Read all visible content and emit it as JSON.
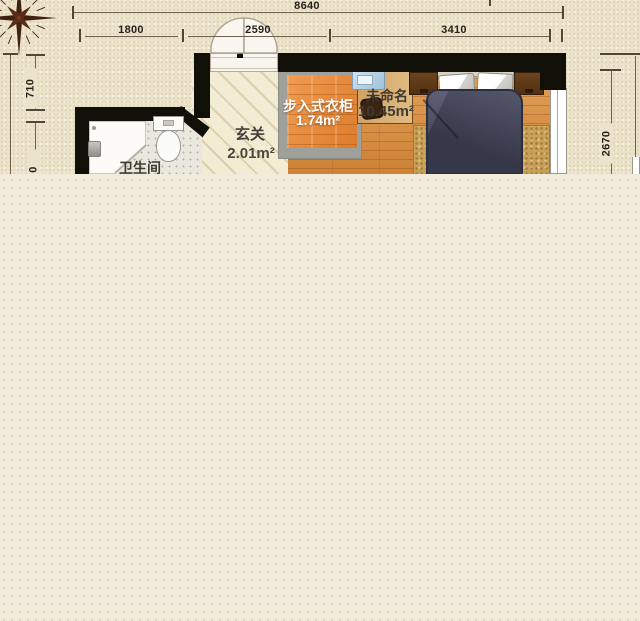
{
  "plan": {
    "title": "apartment-floor-plan",
    "dimensions": {
      "total_width": "8640",
      "segments": [
        "1800",
        "2590",
        "3410"
      ],
      "left_upper": "710",
      "left_lower_partial": "0",
      "right_inner": "2670"
    },
    "rooms": {
      "bathroom": {
        "name": "卫生间"
      },
      "entry": {
        "name": "玄关",
        "area": "2.01m²"
      },
      "closet": {
        "name": "步入式衣柜",
        "area": "1.74m²"
      },
      "bedroom": {
        "name": "未命名",
        "area": "10.45m²"
      }
    },
    "colors": {
      "paper": "#ece3cc",
      "canvas": "#f1ebdc",
      "wall": "#111008",
      "wood_floor": "#d68e47",
      "closet_floor": "#e8873b",
      "entry_floor": "#f3ecd4",
      "tile_floor": "#eae7de",
      "duvet": "#42445a",
      "rug": "#c9a058",
      "nightstand": "#5e3a1c",
      "desk": "#d8b176",
      "laptop": "#9ec0da",
      "dimension_line": "#6e6150",
      "compass": "#40200f"
    }
  }
}
